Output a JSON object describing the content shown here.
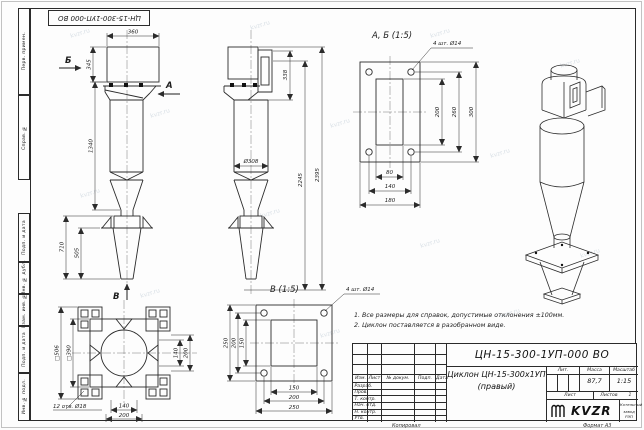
{
  "stamp_top": "ЦН-15-300-1УП-000 ВО",
  "watermark": "kvzr.ru",
  "frame": {
    "left_labels": [
      "Перв. примен.",
      "Справ. №",
      "Подп. и дата",
      "Инв. № дубл.",
      "Взам. инв. №",
      "Подп. и дата",
      "Инв. № подл."
    ],
    "footer_copy": "Копировал",
    "footer_format": "Формат А3"
  },
  "views": {
    "front": {
      "dim_width": "360",
      "dim_inlet_h": "345",
      "dim_body": "1340",
      "dim_support": "710",
      "dim_cone": "505",
      "label_a": "А",
      "label_b": "Б",
      "label_v": "В"
    },
    "side": {
      "dim_offset": "338",
      "dim_h1": "2245",
      "dim_h2": "2395",
      "dim_dia": "Ø308"
    },
    "detail_ab": {
      "title": "А, Б (1:5)",
      "holes_note": "4 шт. Ø14",
      "dim_h": [
        "80",
        "140",
        "180"
      ],
      "dim_v": [
        "200",
        "260",
        "300"
      ]
    },
    "bottom_view": {
      "dim_sq_outer": "□506",
      "dim_sq_inner": "□390",
      "holes_note": "12 отв. Ø18",
      "dim_h": [
        "140",
        "200"
      ],
      "dim_v": [
        "140",
        "200"
      ]
    },
    "detail_v": {
      "title": "В (1:5)",
      "holes_note": "4 шт. Ø14",
      "dim_h": [
        "150",
        "200",
        "250"
      ],
      "dim_v": [
        "150",
        "200",
        "250"
      ]
    }
  },
  "notes": {
    "line1": "1. Все размеры для справок, допустимые отклонения ±100мм.",
    "line2": "2. Циклон поставляется в разобранном виде."
  },
  "title_block": {
    "doc_number": "ЦН-15-300-1УП-000 ВО",
    "name_line1": "Циклон ЦН-15-300х1УП",
    "name_line2": "(правый)",
    "header_cols": [
      "Изм.",
      "Лист",
      "№ докум.",
      "Подп.",
      "Дата"
    ],
    "sign_rows": [
      "Разраб.",
      "Пров.",
      "Т. контр.",
      "Нач. отд.",
      "Н. контр.",
      "Утв."
    ],
    "lit_label": "Лит.",
    "mass_label": "Масса",
    "scale_label": "Масштаб",
    "mass_value": "87,7",
    "scale_value": "1:15",
    "sheet_label": "Лист",
    "sheets_label": "Листов",
    "sheets_value": "1",
    "logo": "KVZR",
    "logo_caption1": "Котельный",
    "logo_caption2": "завод РЭП"
  }
}
